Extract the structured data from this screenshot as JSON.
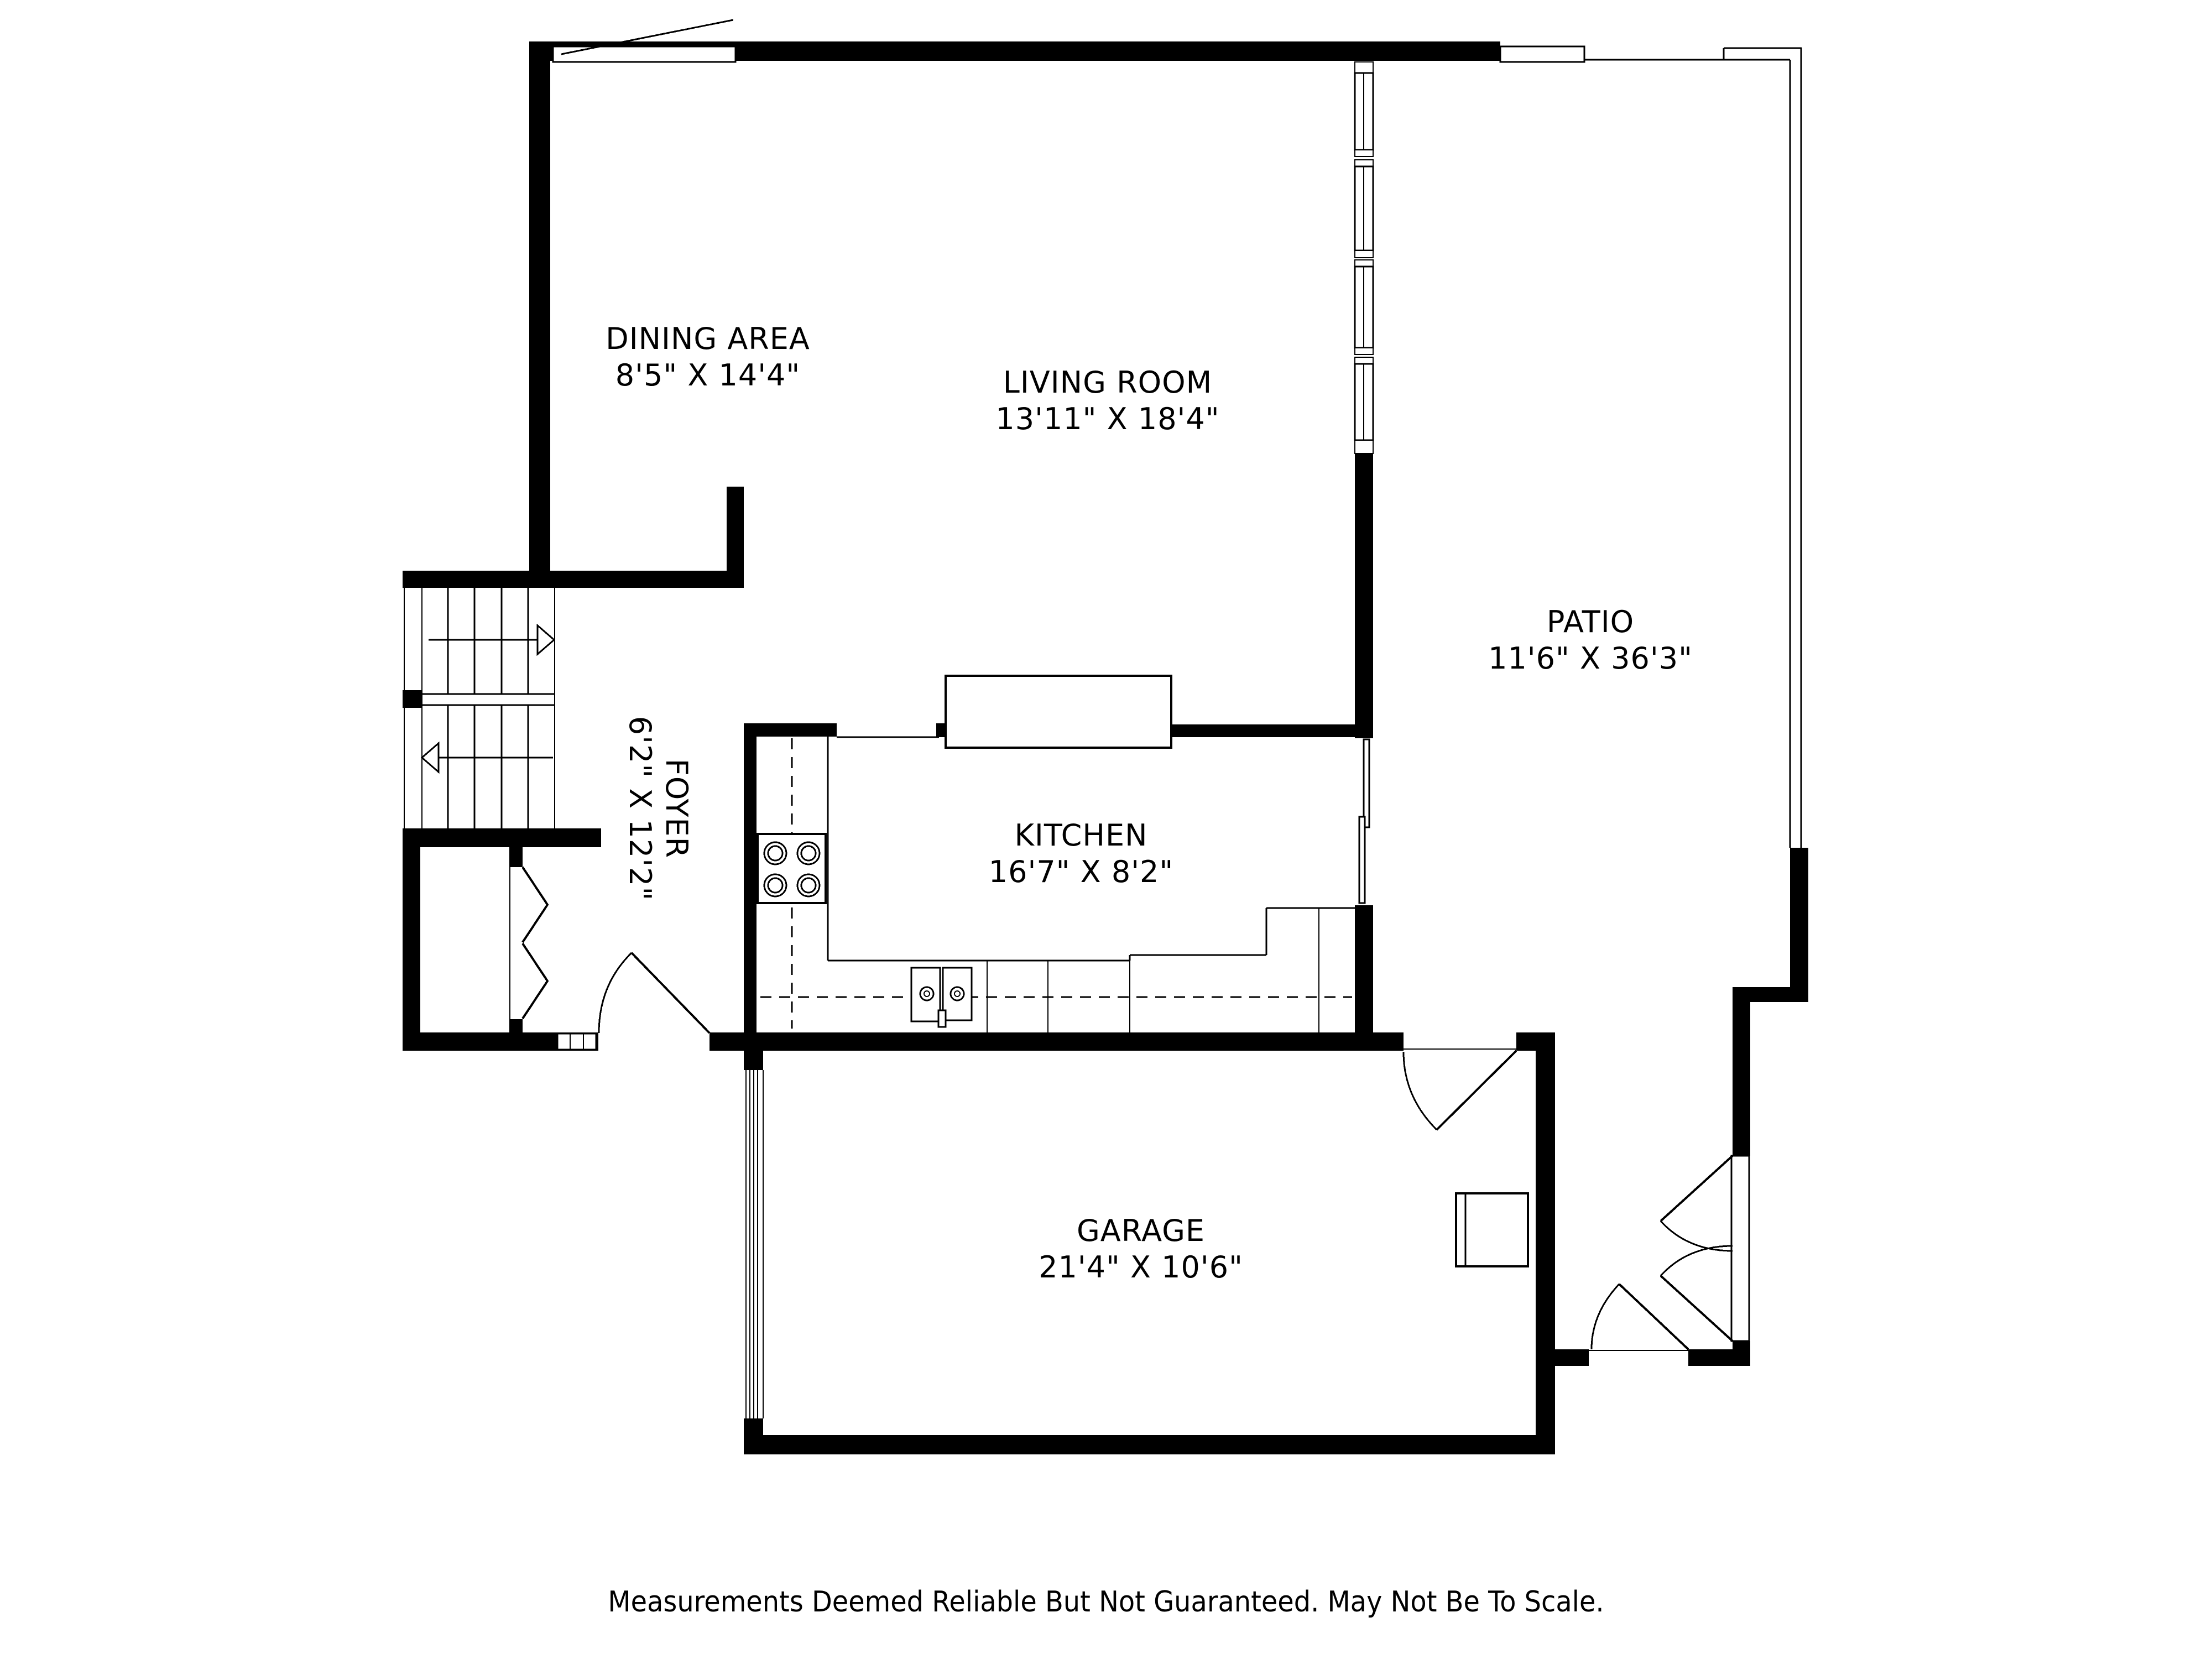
{
  "plan": {
    "background": "#ffffff",
    "wall_color": "#000000",
    "rooms": [
      {
        "name": "DINING AREA",
        "dims": "8'5\" X 14'4\""
      },
      {
        "name": "LIVING ROOM",
        "dims": "13'11\" X 18'4\""
      },
      {
        "name": "PATIO",
        "dims": "11'6\" X 36'3\""
      },
      {
        "name": "FOYER",
        "dims": "6'2\" X 12'2\""
      },
      {
        "name": "KITCHEN",
        "dims": "16'7\" X 8'2\""
      },
      {
        "name": "GARAGE",
        "dims": "21'4\" X 10'6\""
      }
    ],
    "fixtures": {
      "stove_burners": 4,
      "sink_basins": 2,
      "stair_up_arrow_direction": "right",
      "stair_down_arrow_direction": "left"
    },
    "footer": {
      "disclaimer": "Measurements Deemed Reliable But Not Guaranteed. May Not Be To Scale."
    }
  }
}
